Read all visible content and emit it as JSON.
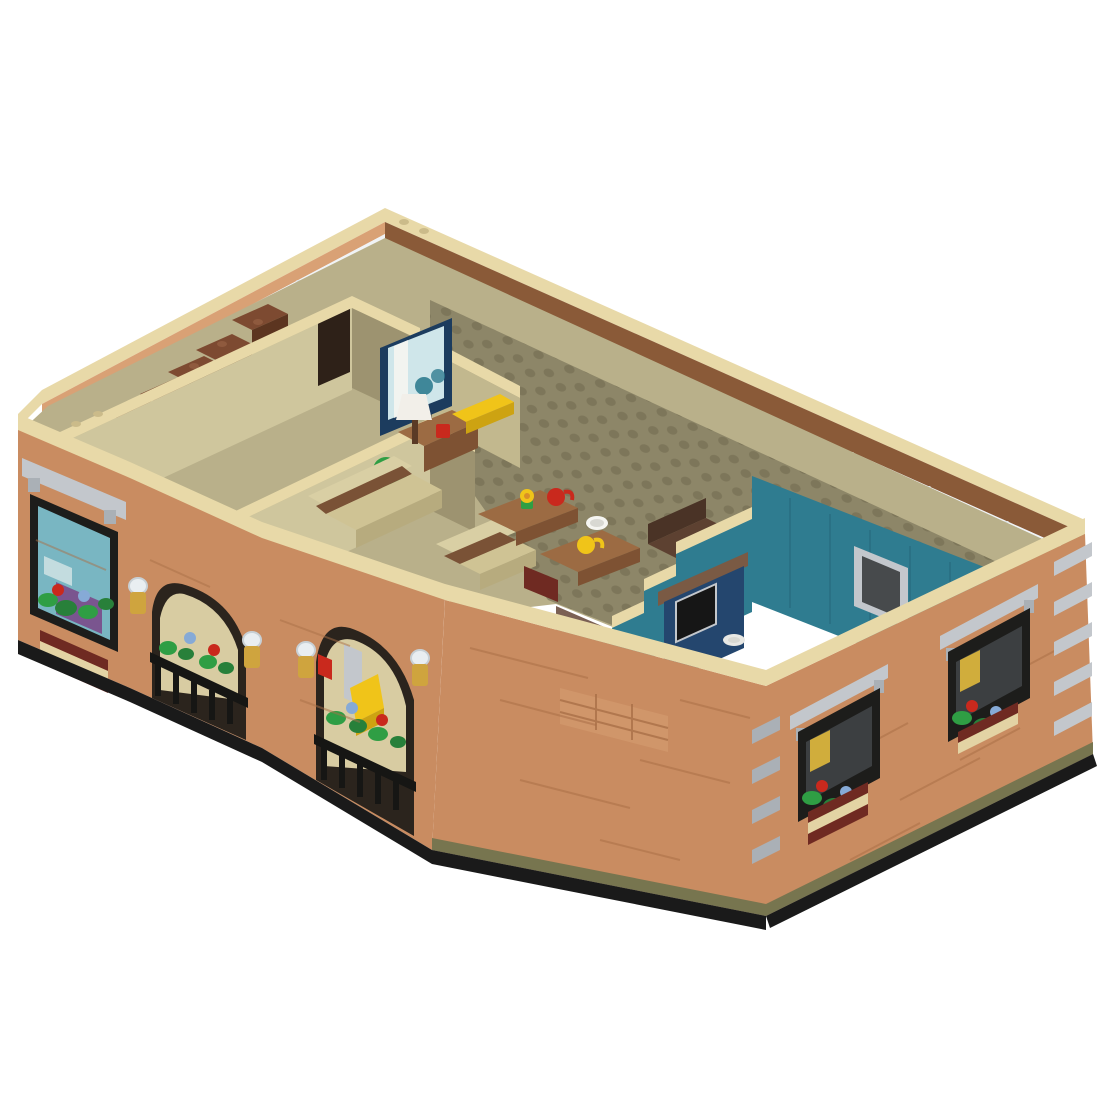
{
  "scene": {
    "background": "#ffffff",
    "view": "isometric-cutaway",
    "subject": "LEGO-style modular apartment floor model",
    "description": "Isometric 3D render of a LEGO-style apartment building cross-section with open top: living room with sofas, coffee tables and mugs, teal-walled kitchen with navy cabinets and sink, bedroom, bathroom and brown staircase; brick exterior with arched porch, black railings, gold lanterns, gray lintels, black windows and flower boxes, on a plain white background."
  },
  "rooms": {
    "living_room": "living room",
    "kitchen": "kitchen",
    "bedroom": "bedroom",
    "bathroom": "bathroom",
    "stair_hall": "stair hall",
    "porch": "arched porch"
  },
  "exterior_features": [
    "tan wall copings",
    "brick facades",
    "gray corner quoins",
    "gray window lintels",
    "black window frames",
    "flower boxes with red and blue roses",
    "gold lanterns with clear tops",
    "two arched porch openings with black railings",
    "continuous glass curtain wall",
    "black base plates"
  ],
  "interior_features": [
    "studded olive floor plates",
    "brown staircase",
    "wall TV with blue frame",
    "white table lamp",
    "green plant",
    "tan and brown sofas",
    "two brown coffee tables",
    "red mug",
    "yellow mug",
    "white bowl",
    "yellow flower pot",
    "teal kitchen walls with pass-through window",
    "navy kitchen cabinets",
    "white sink",
    "yellow chair on porch"
  ],
  "palette": {
    "bg": "#ffffff",
    "tan": "#e8d9a8",
    "tanShade": "#cbbb8a",
    "brick": "#c98c61",
    "brickLight": "#d9a175",
    "brickLine": "#a96f47",
    "brownBand": "#8a5a38",
    "brownSill": "#7d512f",
    "glass": "#eef2f5",
    "glassEdge": "#c9d2d7",
    "mullion": "#dfe4e7",
    "oliveInterior": "#b9b08a",
    "oliveWallLight": "#cfc69d",
    "oliveWallDark": "#9d9370",
    "oliveWallMid": "#c2b88e",
    "floor": "#8d8668",
    "stud": "#7a7357",
    "teal": "#2f7c90",
    "tealDark": "#26657a",
    "gray": "#c3c7cc",
    "grayDark": "#aab0b6",
    "frameBlack": "#1d1d1b",
    "archShadow": "#2b241d",
    "interiorTan": "#d8cca2",
    "railBlack": "#161614",
    "green": "#2f9e44",
    "greenDark": "#28803a",
    "flowerRed": "#c9291d",
    "flowerBlue": "#86aad6",
    "flowerCenter": "#d98f27",
    "gold": "#cfa43e",
    "clearPart": "#e9eef1",
    "clearStroke": "#c8d0d5",
    "yellow": "#f0c419",
    "yellowDark": "#cda312",
    "white": "#f5f5f1",
    "whiteDim": "#d8d8d2",
    "navy": "#1c3c5e",
    "panelBlue": "#cfe6ea",
    "purple": "#7a4a8a",
    "glassInterior": "#79b6c2",
    "medBrown": "#9c6b43",
    "medBrownDark": "#7e5233",
    "sofaTan": "#d9cfa4",
    "sofaTrim": "#7a5236",
    "sofaSeat": "#cfc394",
    "sofaFront": "#b7ab7e",
    "darkBrown": "#5d4131",
    "darkBrownDk": "#4a3326",
    "darkBrownFront": "#3f2b20",
    "mauve": "#7b6054",
    "stairTop": "#7d4a31",
    "stairSide": "#5c3520",
    "stairStud": "#8f5a3e",
    "doorDark": "#2e2118",
    "cabinetNavy": "#24466e",
    "counterBrown": "#7a5a44",
    "sinkWhite": "#e8e8e4",
    "boxRed": "#6f2a22",
    "boxTan": "#e3d3a4",
    "baseBlack": "#1a1a1a",
    "baseOlive": "#77754f",
    "curtainYellow": "#e0b93c",
    "lampWhite": "#f2efe9",
    "lampStem": "#5a3a26"
  }
}
